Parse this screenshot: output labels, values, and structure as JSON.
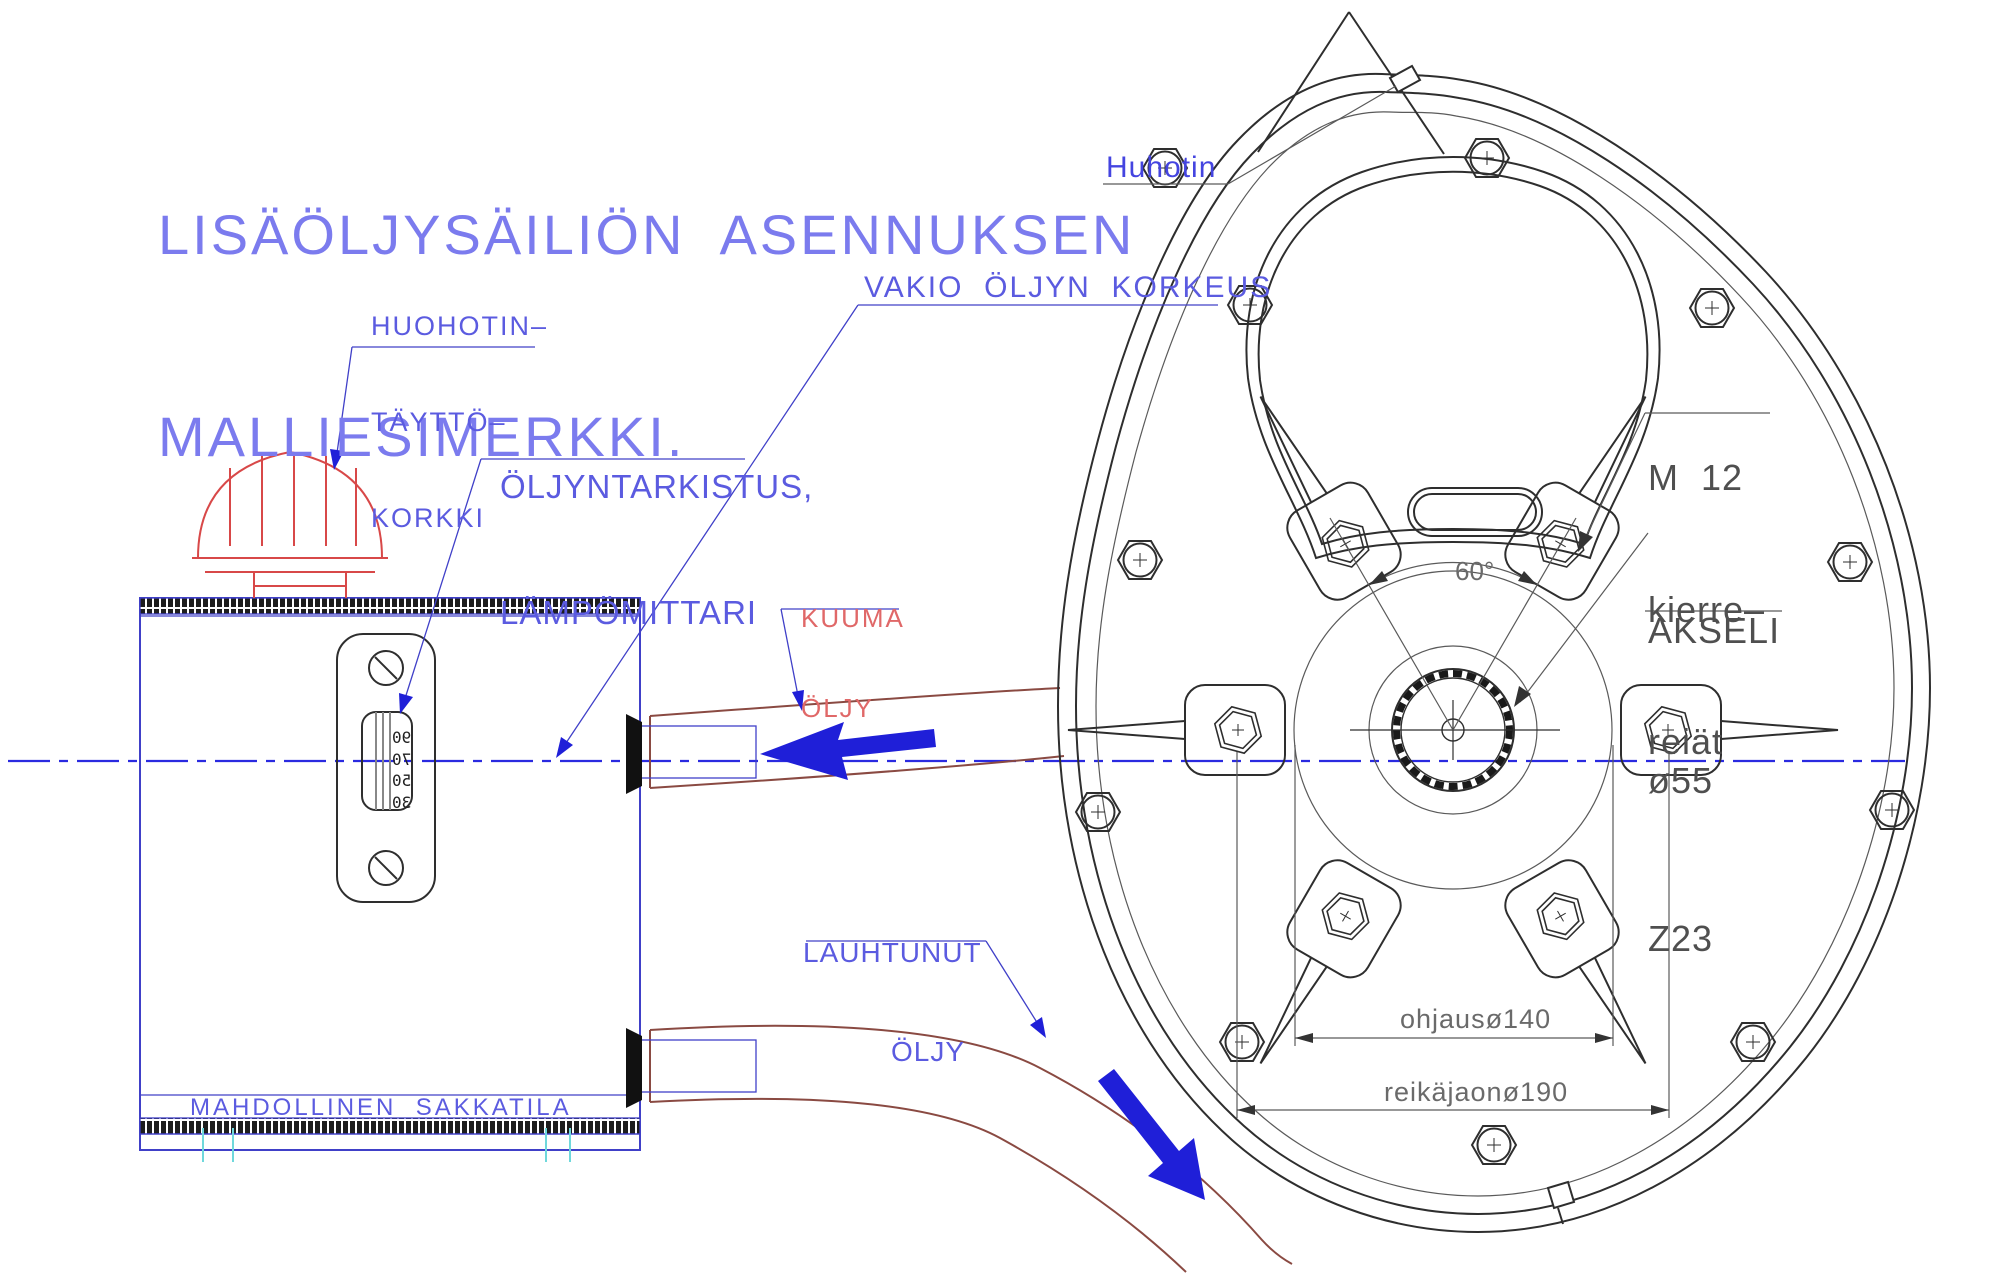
{
  "title": {
    "line1": "LISÄÖLJYSÄILIÖN  ASENNUKSEN",
    "line2": "MALLIESIMERKKI."
  },
  "labels": {
    "filler_cap": {
      "l1": "HUOHOTIN–",
      "l2": "TÄYTTÖ–",
      "l3": "KORKKI"
    },
    "oil_check": {
      "l1": "ÖLJYNTARKISTUS,",
      "l2": "LÄMPÖMITTARI"
    },
    "oil_level": "VAKIO  ÖLJYN  KORKEUS",
    "hot_oil": {
      "l1": "KUUMA",
      "l2": "ÖLJY"
    },
    "cooled_oil": {
      "l1": "LAUHTUNUT",
      "l2": "ÖLJY"
    },
    "breather": "Huhotin",
    "thread": {
      "l1": "M  12",
      "l2": "kierre–",
      "l3": "reiät"
    },
    "axle": {
      "l1": "AKSELI",
      "l2": "ø55",
      "l3": "Z23"
    },
    "sludge": "MAHDOLLINEN  SAKKATILA"
  },
  "dimensions": {
    "angle": "60°",
    "guide": "ohjausø140",
    "bolt_circle": "reikäjaonø190"
  },
  "sight_glass_scale": [
    "90",
    "70",
    "50",
    "30"
  ],
  "colors": {
    "title_blue": "#7b7bee",
    "label_blue": "#5b5be0",
    "hot_red": "#e06868",
    "cap_red": "#d84848",
    "line_dark": "#2e2e2e",
    "pipe_brown": "#8a4a42",
    "flow_arrow_blue": "#1f1fd8",
    "tank_blue": "#4040c8",
    "centerline_blue": "#2a2ae0",
    "weld_cyan": "#6fd8dc"
  }
}
